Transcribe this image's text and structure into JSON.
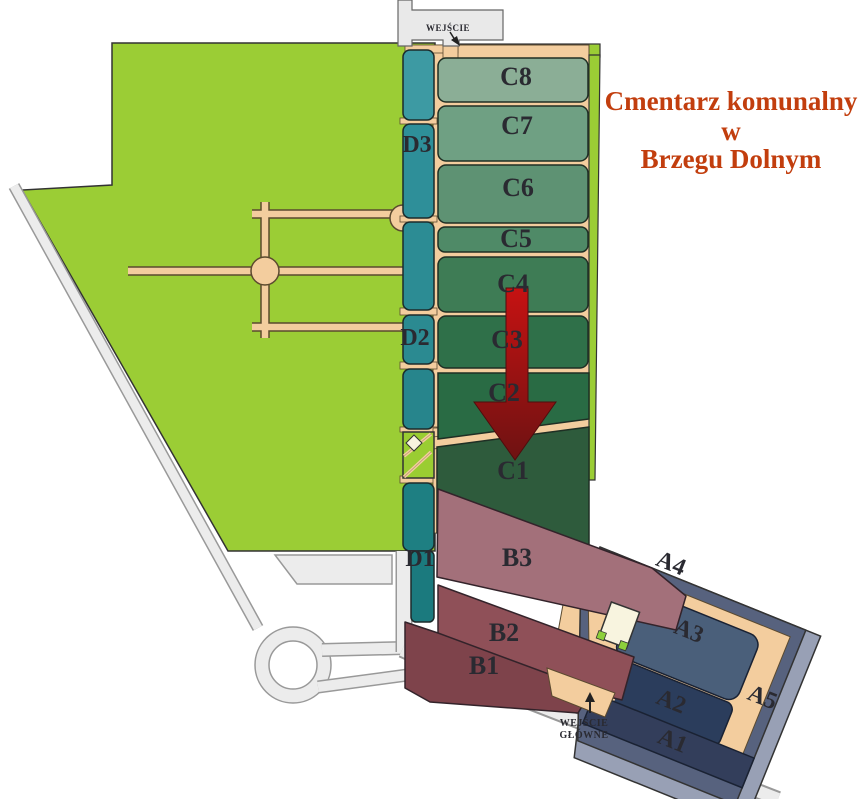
{
  "title": {
    "line1": "Cmentarz komunalny",
    "line2": "w",
    "line3": "Brzegu Dolnym",
    "color": "#C23E0E"
  },
  "entrances": {
    "top_label": "WEJŚCIE",
    "main_label_line1": "WEJŚCIE",
    "main_label_line2": "GŁÓWNE"
  },
  "sections": {
    "a1": "A1",
    "a2": "A2",
    "a3": "A3",
    "a4": "A4",
    "a5": "A5",
    "b1": "B1",
    "b2": "B2",
    "b3": "B3",
    "c1": "C1",
    "c2": "C2",
    "c3": "C3",
    "c4": "C4",
    "c5": "C5",
    "c6": "C6",
    "c7": "C7",
    "c8": "C8",
    "d1": "D1",
    "d2": "D2",
    "d3": "D3"
  },
  "palette": {
    "grass_green": "#9BCD35",
    "path_tan": "#F3CD9E",
    "road_gray": "#ECECEC",
    "teal_strip": "#2E8F99",
    "c8": "#8BAE96",
    "c7": "#6FA083",
    "c6": "#5E9273",
    "c5": "#4F8A67",
    "c4": "#3E7C55",
    "c3": "#2F7049",
    "c2": "#296B44",
    "c1": "#2E5B3C",
    "b3": "#A3707A",
    "b2": "#8F5058",
    "b1": "#7E434B",
    "a3": "#4A5F7A",
    "a2": "#2B3D5C",
    "a1": "#333E5B",
    "a_band_dark": "#57627E",
    "a_band_light": "#98A0B5",
    "arrow_red_top": "#C61212",
    "arrow_red_bottom": "#6E1212",
    "building_cream": "#F8F4DF"
  }
}
